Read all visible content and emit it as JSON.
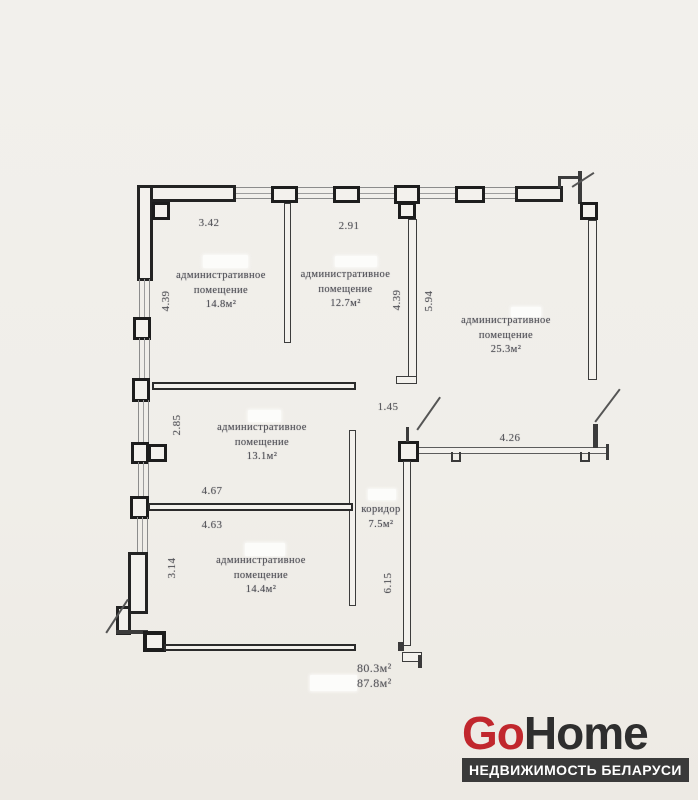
{
  "plan": {
    "rooms": [
      {
        "name": "административное помещение",
        "area": "14.8м²"
      },
      {
        "name": "административное помещение",
        "area": "12.7м²"
      },
      {
        "name": "административное помещение",
        "area": "25.3м²"
      },
      {
        "name": "административное помещение",
        "area": "13.1м²"
      },
      {
        "name": "административное помещение",
        "area": "14.4м²"
      },
      {
        "name": "коридор",
        "area": "7.5м²"
      }
    ],
    "dims": {
      "top_left": "3.42",
      "top_mid": "2.91",
      "left_upper": "4.39",
      "mid_wall_left": "4.39",
      "mid_wall_right": "5.94",
      "left_middle": "2.85",
      "corridor_top": "1.45",
      "right_lower": "4.26",
      "room13_width": "4.67",
      "room14_width": "4.63",
      "left_lower": "3.14",
      "corridor_height": "6.15"
    },
    "totals": {
      "line1": "80.3м²",
      "line2": "87.8м²"
    }
  },
  "logo": {
    "go": "Go",
    "home": "Home",
    "tagline": "НЕДВИЖИМОСТЬ БЕЛАРУСИ",
    "accent_color": "#c1272d",
    "dark_color": "#2e2e2e",
    "bar_color": "#3a3a3a"
  }
}
